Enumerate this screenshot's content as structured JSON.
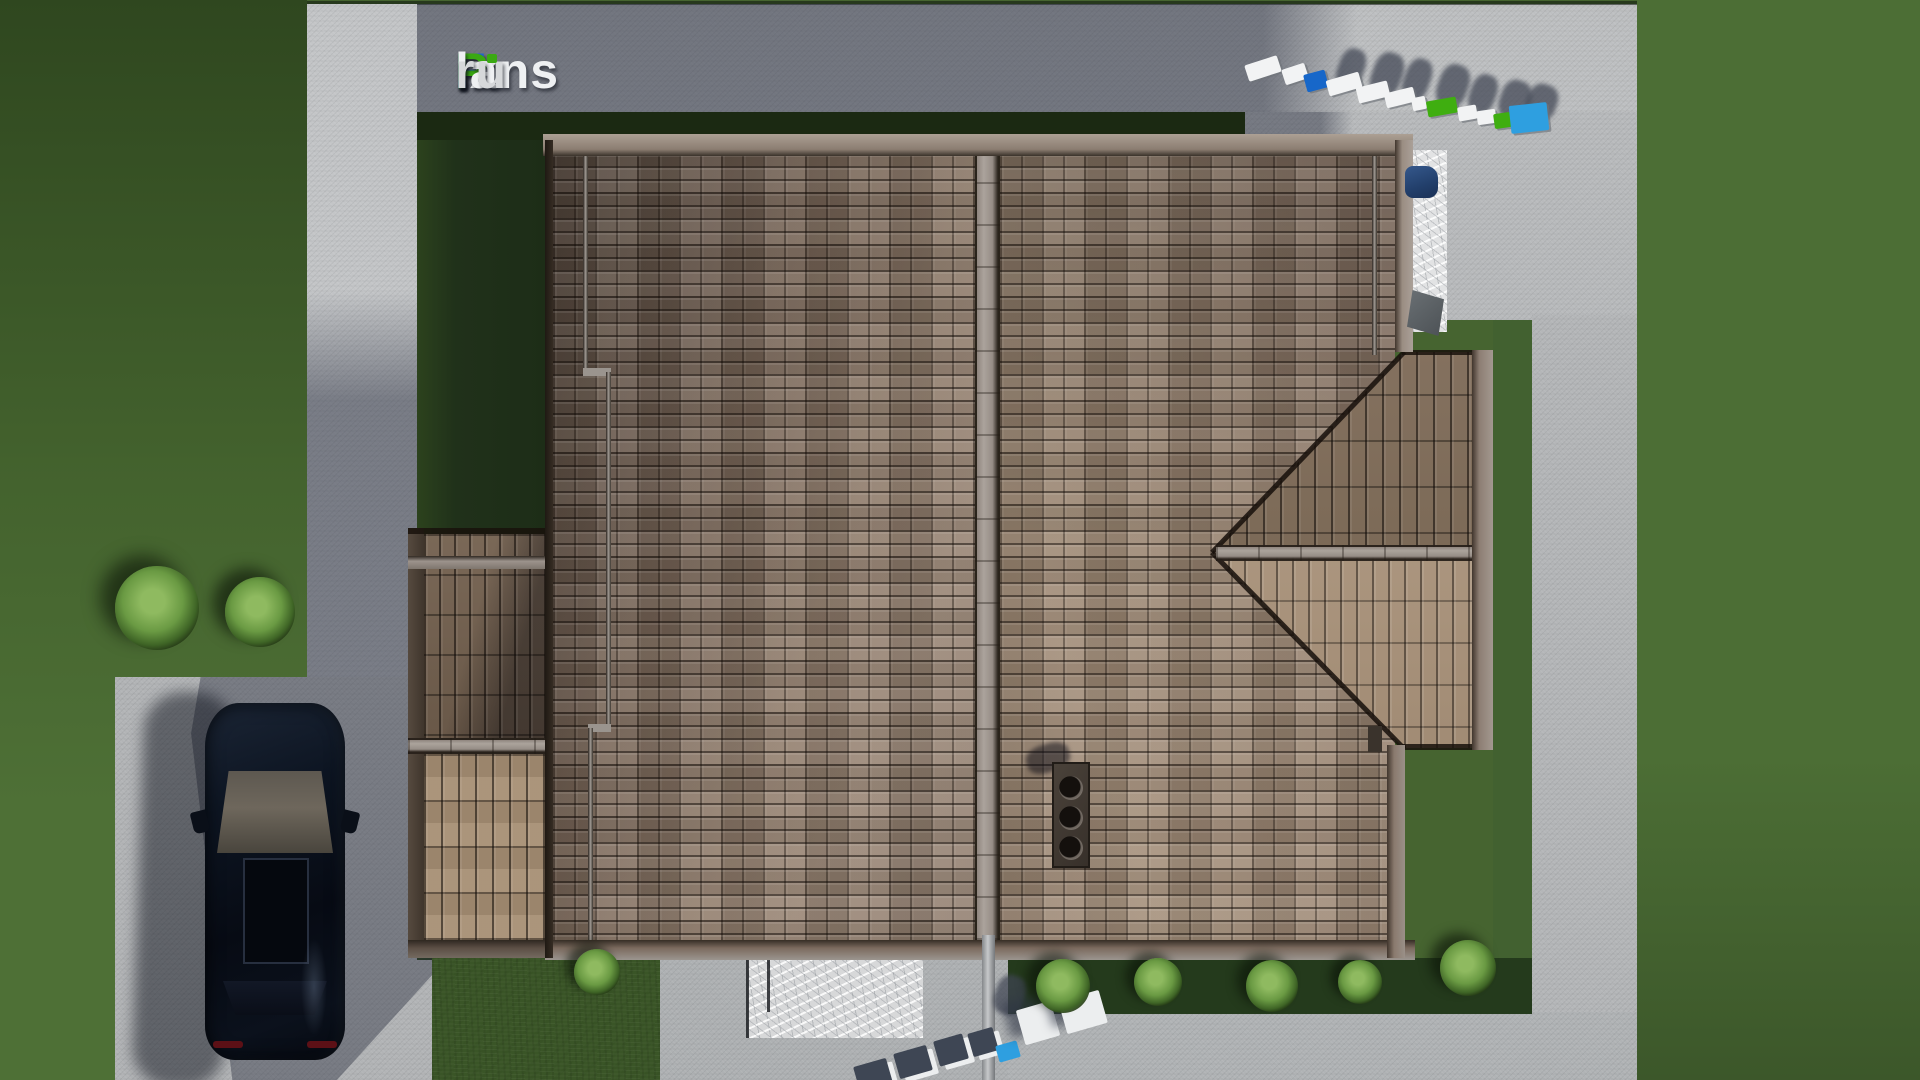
{
  "site": {
    "brand_text": "FixPlans.ru",
    "watermark_top_text": "FixPlans.ru",
    "watermark_bottom_text": "lans.ru"
  },
  "logo": {
    "parts": [
      {
        "text": "F",
        "color": "#2166cd"
      },
      {
        "text": "ix",
        "color": "#eef0f2"
      },
      {
        "text": "P",
        "color": "#3aa912"
      },
      {
        "text": "lans",
        "color": "#eef0f2"
      },
      {
        "text": ".",
        "color": "#2166cd"
      },
      {
        "text": "ru",
        "color": "#d6d8da"
      }
    ],
    "i_dot_color": "#3aa912"
  },
  "palette": {
    "grass_base": "#486631",
    "grass_dark_shadow": "#1d2d15",
    "concrete_light": "#bdbfc1",
    "concrete_shadow": "#6f7480",
    "roof_west": "#8a7565",
    "roof_east": "#97826f",
    "wing_north": "#7c6a5a",
    "wing_south": "#b09b85",
    "ridge": "#a29892",
    "fascia": "#7b6a5e",
    "car_body": "#0c121d",
    "white": "#f2f3f4",
    "blue": "#1767c9",
    "green": "#3fae10",
    "cyan": "#2e9fe0",
    "navyTop": "#3e4654",
    "whiteTop": "#eceeef"
  },
  "scene": {
    "bushes": [
      {
        "cx": 157,
        "cy": 608,
        "r": 42,
        "tone": "light"
      },
      {
        "cx": 260,
        "cy": 612,
        "r": 35,
        "tone": "light"
      },
      {
        "cx": 597,
        "cy": 972,
        "r": 23,
        "tone": "light"
      },
      {
        "cx": 1063,
        "cy": 986,
        "r": 27,
        "tone": "light"
      },
      {
        "cx": 1158,
        "cy": 982,
        "r": 24,
        "tone": "light"
      },
      {
        "cx": 1272,
        "cy": 986,
        "r": 26,
        "tone": "light"
      },
      {
        "cx": 1360,
        "cy": 982,
        "r": 22,
        "tone": "light"
      },
      {
        "cx": 1468,
        "cy": 968,
        "r": 28,
        "tone": "light"
      }
    ],
    "watermark_top": {
      "blocks": [
        {
          "x": 1246,
          "y": 60,
          "w": 34,
          "h": 17,
          "type": "white",
          "rot": -18
        },
        {
          "x": 1283,
          "y": 66,
          "w": 24,
          "h": 16,
          "type": "white",
          "rot": -18
        },
        {
          "x": 1305,
          "y": 72,
          "w": 22,
          "h": 18,
          "type": "blue",
          "rot": -15
        },
        {
          "x": 1327,
          "y": 76,
          "w": 34,
          "h": 16,
          "type": "white",
          "rot": -16
        },
        {
          "x": 1357,
          "y": 84,
          "w": 32,
          "h": 16,
          "type": "white",
          "rot": -14
        },
        {
          "x": 1385,
          "y": 90,
          "w": 30,
          "h": 15,
          "type": "white",
          "rot": -14
        },
        {
          "x": 1412,
          "y": 97,
          "w": 14,
          "h": 13,
          "type": "white",
          "rot": -12
        },
        {
          "x": 1427,
          "y": 99,
          "w": 30,
          "h": 16,
          "type": "green",
          "rot": -10
        },
        {
          "x": 1458,
          "y": 106,
          "w": 19,
          "h": 14,
          "type": "white",
          "rot": -10
        },
        {
          "x": 1477,
          "y": 110,
          "w": 19,
          "h": 14,
          "type": "white",
          "rot": -8
        },
        {
          "x": 1494,
          "y": 113,
          "w": 17,
          "h": 15,
          "type": "green",
          "rot": -8
        },
        {
          "x": 1510,
          "y": 104,
          "w": 38,
          "h": 28,
          "type": "cyan",
          "rot": -6
        }
      ],
      "shadows": [
        {
          "x": 1338,
          "y": 48,
          "w": 26,
          "h": 42
        },
        {
          "x": 1372,
          "y": 52,
          "w": 30,
          "h": 46
        },
        {
          "x": 1404,
          "y": 58,
          "w": 26,
          "h": 44
        },
        {
          "x": 1438,
          "y": 64,
          "w": 30,
          "h": 44
        },
        {
          "x": 1470,
          "y": 74,
          "w": 26,
          "h": 40
        },
        {
          "x": 1500,
          "y": 80,
          "w": 30,
          "h": 40
        },
        {
          "x": 1527,
          "y": 84,
          "w": 30,
          "h": 36
        }
      ]
    },
    "watermark_bottom": {
      "blocks": [
        {
          "x": 856,
          "y": 1062,
          "w": 34,
          "h": 26,
          "type": "navyTop",
          "rot": -16
        },
        {
          "x": 896,
          "y": 1049,
          "w": 34,
          "h": 26,
          "type": "navyTop",
          "rot": -16
        },
        {
          "x": 936,
          "y": 1037,
          "w": 30,
          "h": 26,
          "type": "navyTop",
          "rot": -16
        },
        {
          "x": 970,
          "y": 1030,
          "w": 26,
          "h": 24,
          "type": "navyTop",
          "rot": -16
        },
        {
          "x": 997,
          "y": 1043,
          "w": 22,
          "h": 17,
          "type": "cyan",
          "rot": -16
        },
        {
          "x": 1020,
          "y": 1005,
          "w": 36,
          "h": 36,
          "type": "whiteTop",
          "rot": -16
        },
        {
          "x": 1062,
          "y": 995,
          "w": 42,
          "h": 34,
          "type": "whiteTop",
          "rot": -16
        }
      ],
      "shadows": [
        {
          "x": 995,
          "y": 975,
          "w": 30,
          "h": 40
        },
        {
          "x": 1040,
          "y": 965,
          "w": 34,
          "h": 40
        }
      ]
    }
  }
}
